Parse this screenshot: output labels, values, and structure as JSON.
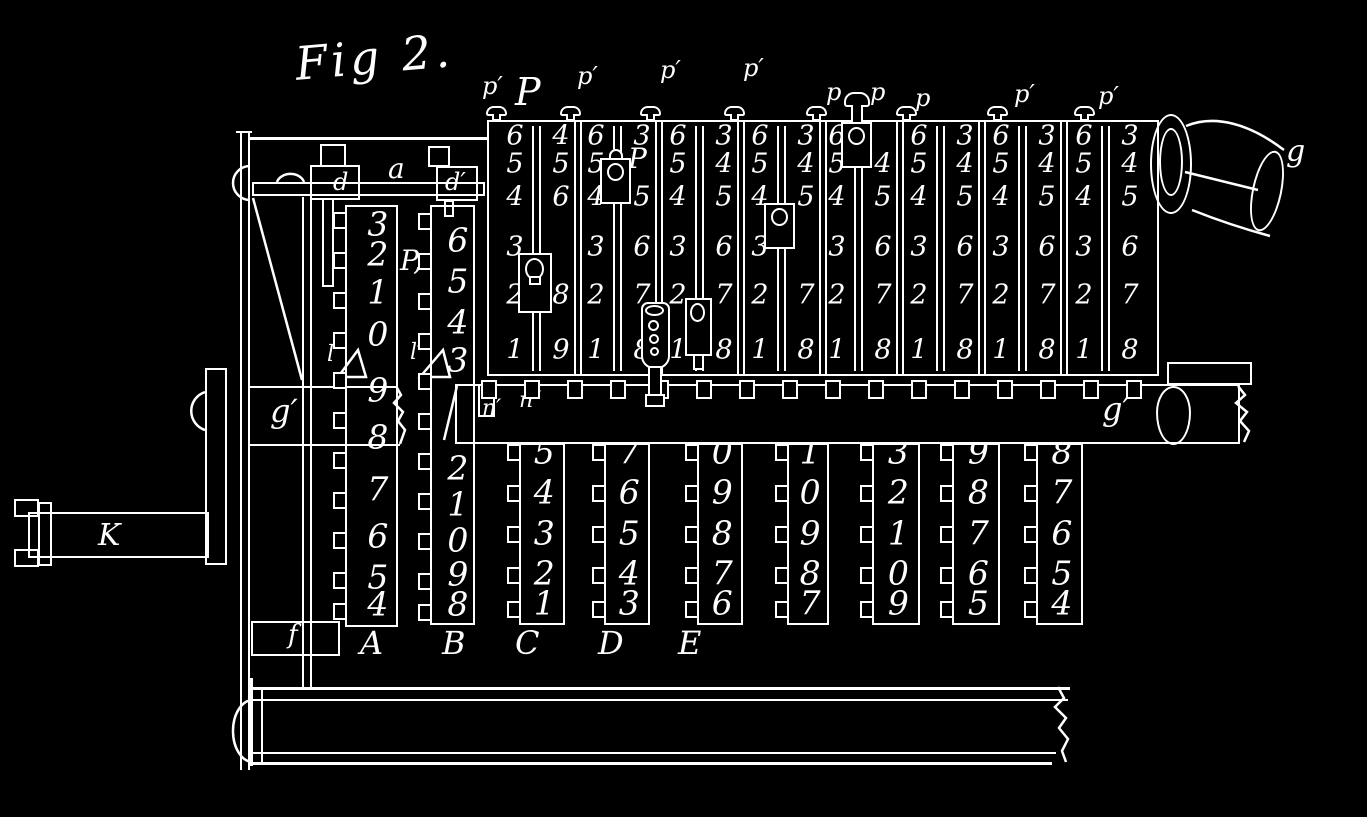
{
  "figure": {
    "title": "Fig 2."
  },
  "panel": {
    "top_labels": [
      "p′",
      "P",
      "p′",
      "p′",
      "p′",
      "p",
      "p",
      "p",
      "p′",
      "p′"
    ],
    "slider_label": "P",
    "notch_labels": [
      "n′",
      "n″"
    ],
    "columns": [
      {
        "left": [
          6,
          5,
          4,
          3,
          2,
          1
        ],
        "right": [
          4,
          5,
          6,
          null,
          8,
          9
        ],
        "slider": "mid-low"
      },
      {
        "left": [
          6,
          5,
          4,
          3,
          2,
          1
        ],
        "right": [
          3,
          null,
          5,
          6,
          7,
          8
        ],
        "slider": "upper"
      },
      {
        "left": [
          6,
          5,
          4,
          3,
          2,
          1
        ],
        "right": [
          3,
          4,
          5,
          6,
          7,
          8
        ],
        "slider": "pin-low"
      },
      {
        "left": [
          6,
          5,
          4,
          3,
          2,
          1
        ],
        "right": [
          3,
          4,
          5,
          null,
          7,
          8
        ],
        "slider": "mid"
      },
      {
        "left": [
          6,
          5,
          4,
          3,
          2,
          1
        ],
        "right": [
          null,
          4,
          5,
          6,
          7,
          8
        ],
        "slider": "top"
      },
      {
        "left": [
          6,
          5,
          4,
          3,
          2,
          1
        ],
        "right": [
          3,
          4,
          5,
          6,
          7,
          8
        ],
        "slider": null
      },
      {
        "left": [
          6,
          5,
          4,
          3,
          2,
          1
        ],
        "right": [
          3,
          4,
          5,
          6,
          7,
          8
        ],
        "slider": null
      },
      {
        "left": [
          6,
          5,
          4,
          3,
          2,
          1
        ],
        "right": [
          3,
          4,
          5,
          6,
          7,
          8
        ],
        "slider": null
      }
    ]
  },
  "left_assembly": {
    "rail_label": "a",
    "slide_label": "d",
    "slide2_label": "d′",
    "rack_label": "P,",
    "wedge_label": "l",
    "wedge2_label": "l′",
    "gear_label": "g′",
    "plate_label": "f",
    "crank_label": "K"
  },
  "carriage": {
    "bar_label": "g′",
    "roller_label": "g"
  },
  "racks": [
    {
      "label": "A",
      "upper": [
        3,
        2,
        1,
        0
      ],
      "lower": [
        9,
        8,
        7,
        6,
        5,
        4
      ]
    },
    {
      "label": "B",
      "upper": [
        6,
        5,
        4,
        3
      ],
      "lower": [
        2,
        1,
        0,
        9,
        8
      ]
    },
    {
      "label": "C",
      "lower": [
        5,
        4,
        3,
        2,
        1
      ]
    },
    {
      "label": "D",
      "lower": [
        7,
        6,
        5,
        4,
        3
      ]
    },
    {
      "label": "E",
      "lower": [
        0,
        9,
        8,
        7,
        6
      ]
    },
    {
      "label": "",
      "lower": [
        1,
        0,
        9,
        8,
        7
      ]
    },
    {
      "label": "",
      "lower": [
        3,
        2,
        1,
        0,
        9
      ]
    },
    {
      "label": "",
      "lower": [
        9,
        8,
        7,
        6,
        5
      ]
    },
    {
      "label": "",
      "lower": [
        8,
        7,
        6,
        5,
        4
      ]
    }
  ]
}
